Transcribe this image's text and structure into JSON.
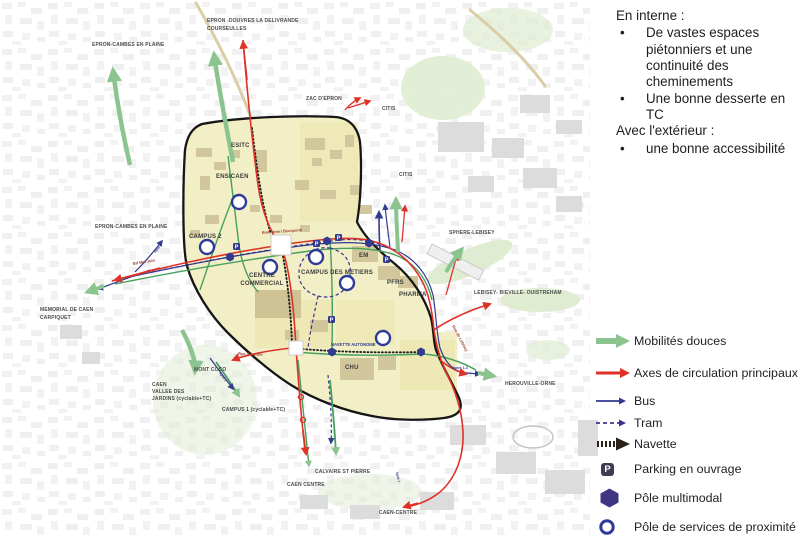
{
  "colors": {
    "red": "#e03127",
    "green_arrow": "#8bc48f",
    "green_line": "#46a05e",
    "navy": "#333a8f",
    "tram": "#3b3490",
    "black": "#1f1f1f",
    "navette_legend": "#2a2118",
    "hex": "#3f3680",
    "ring": "#2e3a97",
    "campus": "#f2efc6",
    "campus_block": "#ebe4a9",
    "building_tan": "#d2c79c",
    "building_gray": "#dcdcdc",
    "park": "#dfecd2",
    "road_tan": "#dbcda6",
    "parking_bg": "#3d3d52"
  },
  "notes": {
    "heading_internal": "En interne :",
    "bullet_1": "De vastes espaces piétonniers et une continuité des cheminements",
    "bullet_2": "Une bonne desserte en TC",
    "heading_external": "Avec l'extérieur :",
    "bullet_3": "une bonne accessibilité",
    "bullet_char": "•"
  },
  "legend": {
    "items": [
      {
        "id": "mobilites-douces",
        "label": "Mobilités douces"
      },
      {
        "id": "axes-circulation",
        "label": "Axes de circulation principaux"
      },
      {
        "id": "bus",
        "label": "Bus"
      },
      {
        "id": "tram",
        "label": "Tram"
      },
      {
        "id": "navette",
        "label": "Navette"
      },
      {
        "id": "parking",
        "label": "Parking en ouvrage",
        "icon_letter": "P"
      },
      {
        "id": "pole-multimodal",
        "label": "Pôle multimodal"
      },
      {
        "id": "pole-services",
        "label": "Pôle de services de proximité"
      }
    ]
  },
  "map": {
    "parking_letter": "P",
    "campus_labels": {
      "esitc": "ESITC",
      "ensicaen": "ENSICAEN",
      "campus2": "CAMPUS 2",
      "centre_commercial_l1": "CENTRE",
      "centre_commercial_l2": "COMMERCIAL",
      "campus_metiers": "CAMPUS DES METIERS",
      "em": "EM",
      "pfrs": "PFRS",
      "pharma": "PHARMA",
      "chu": "CHU"
    },
    "destinations": {
      "epron_douvres_l1": "EPRON -DOUVRES LA DELIVRANDE",
      "epron_douvres_l2": "COURSEULLES",
      "epron_cambes_nord": "EPRON-CAMBES EN PLAINE",
      "zac_epron": "ZAC D'EPRON",
      "citis_nord": "CITIS",
      "citis_est": "CITIS",
      "sphere_lebisey": "SPHERE-LEBISEY",
      "lebisey_bieville_ouistreham": "LEBISEY- BIEVILLE- OUISTREHAM",
      "herouville_orne": "HEROUVILLE-ORNE",
      "epron_cambes_ouest": "EPRON-CAMBES EN PLAINE",
      "memorial_l1": "MEMORIAL DE CAEN",
      "memorial_l2": "CARPIQUET",
      "mont_coco": "MONT COCO",
      "vallee_l1": "CAEN",
      "vallee_l2": "VALLEE DES",
      "vallee_l3": "JARDINS (cyclable+TC)",
      "campus1": "CAMPUS 1 (cyclable+TC)",
      "calvaire": "CALVAIRE ST PIERRE",
      "caen_centre": "CAEN CENTRE",
      "caen_centre_sud": "CAEN-CENTRE"
    },
    "roads": {
      "becquerel": "Bvd. Henri Becquerel",
      "navette_autonome": "NAVETTE AUTONOME",
      "rue_authie": "Rue d'Authie",
      "rue_lebisey": "Rue de Lébisey",
      "bd_mal_juin": "Bd Mal Juin"
    },
    "line_tags": {
      "lignes_1_4": "lignes 1-4",
      "ligne_1": "ligne 1",
      "ligne_2": "ligne 2",
      "ligne_2b": "ligne 2"
    }
  }
}
